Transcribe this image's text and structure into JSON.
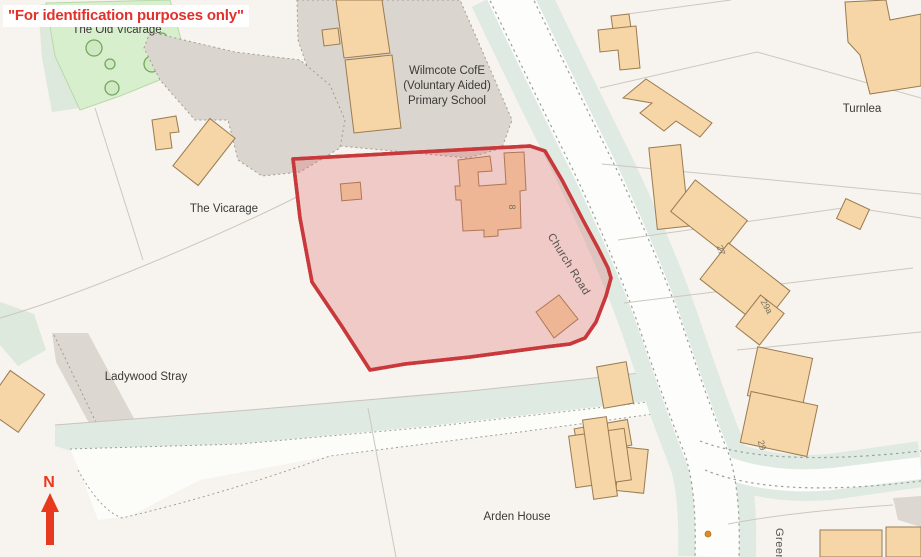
{
  "banner": {
    "text": "\"For identification purposes only\""
  },
  "labels": {
    "old_vicarage": "The Old Vicarage",
    "school_line1": "Wilmcote CofE",
    "school_line2": "(Voluntary Aided)",
    "school_line3": "Primary School",
    "vicarage": "The Vicarage",
    "turnlea": "Turnlea",
    "church_road": "Church Road",
    "ladywood_stray": "Ladywood Stray",
    "arden_house": "Arden House",
    "green_street": "Green",
    "north": "N"
  },
  "house_numbers": {
    "plot": "8",
    "n27": "27",
    "n29a": "29a",
    "n29": "29"
  },
  "colors": {
    "background": "#f7f3ee",
    "banner_text": "#e0312b",
    "highlight_fill": "#dd6d6d",
    "highlight_stroke": "#c9393b",
    "building_fill": "#f6d6a7",
    "building_stroke": "#9a7b50",
    "grass": "#d8efce",
    "verge": "#dfeae2",
    "school_yard": "#dbd5cf",
    "road": "#fdfdfc",
    "north_arrow": "#e8391f"
  }
}
